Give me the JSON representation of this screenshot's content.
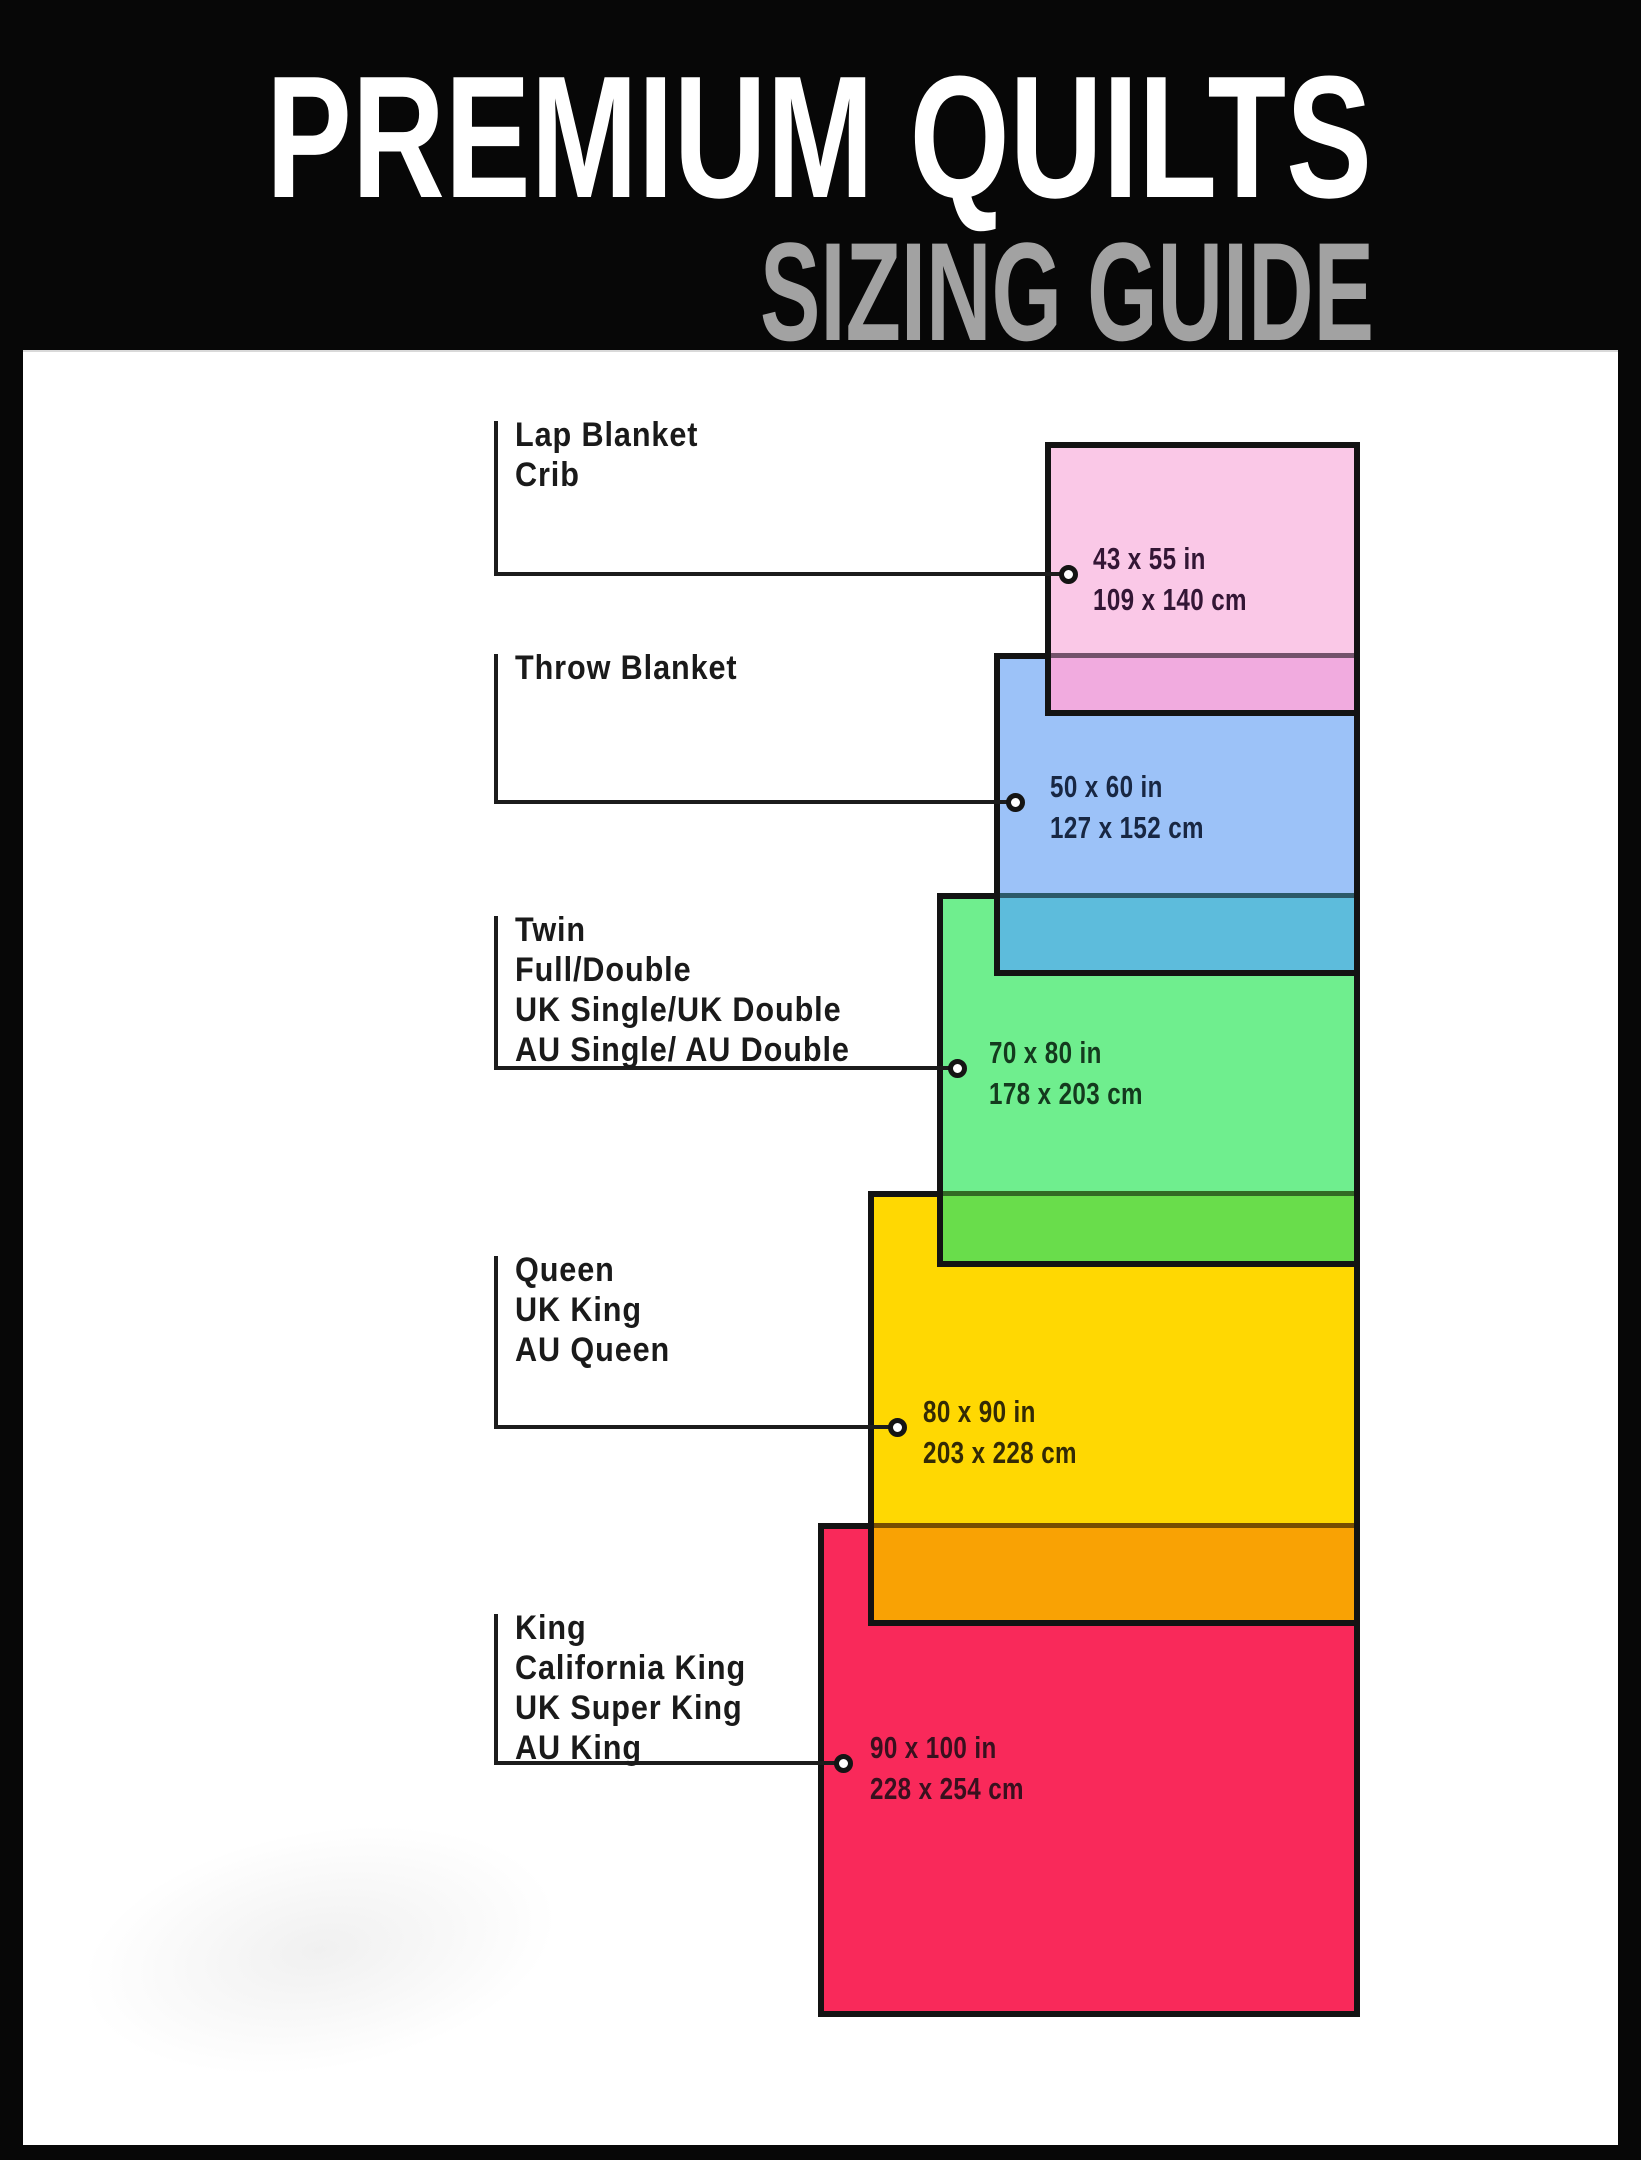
{
  "header": {
    "title": "PREMIUM QUILTS",
    "subtitle": "SIZING GUIDE",
    "background": "#070707",
    "title_color": "#ffffff",
    "subtitle_color": "#a2a2a2"
  },
  "styles": {
    "border_color": "#131313",
    "connector_color": "#1c1c1c",
    "label_color": "#1a1a1a",
    "canvas_color": "#ffffff"
  },
  "blankets": [
    {
      "id": "lap-blanket-crib",
      "labels": [
        "Lap Blanket",
        "Crib"
      ],
      "size_in": "43 x 55 in",
      "size_cm": "109 x 140 cm",
      "fill": "#fac8e7",
      "overlap_fill": "#f1abdf",
      "text_color": "#331635"
    },
    {
      "id": "throw-blanket",
      "labels": [
        "Throw Blanket"
      ],
      "size_in": "50 x 60 in",
      "size_cm": "127 x 152 cm",
      "fill": "#9cc2f8",
      "overlap_fill": "#5dbcdc",
      "text_color": "#182743"
    },
    {
      "id": "twin-full-double",
      "labels": [
        "Twin",
        "Full/Double",
        "UK Single/UK Double",
        "AU Single/ AU Double"
      ],
      "size_in": "70 x 80 in",
      "size_cm": "178 x 203 cm",
      "fill": "#6fee8e",
      "overlap_fill": "#69dd4b",
      "text_color": "#143a1e"
    },
    {
      "id": "queen",
      "labels": [
        "Queen",
        "UK King",
        "AU Queen"
      ],
      "size_in": "80 x 90 in",
      "size_cm": "203 x 228 cm",
      "fill": "#ffd802",
      "overlap_fill": "#f9a204",
      "text_color": "#332a05"
    },
    {
      "id": "king",
      "labels": [
        "King",
        "California King",
        "UK Super King",
        "AU King"
      ],
      "size_in": "90 x 100 in",
      "size_cm": "228 x 254 cm",
      "fill": "#f9295a",
      "overlap_fill": null,
      "text_color": "#38101e"
    }
  ]
}
